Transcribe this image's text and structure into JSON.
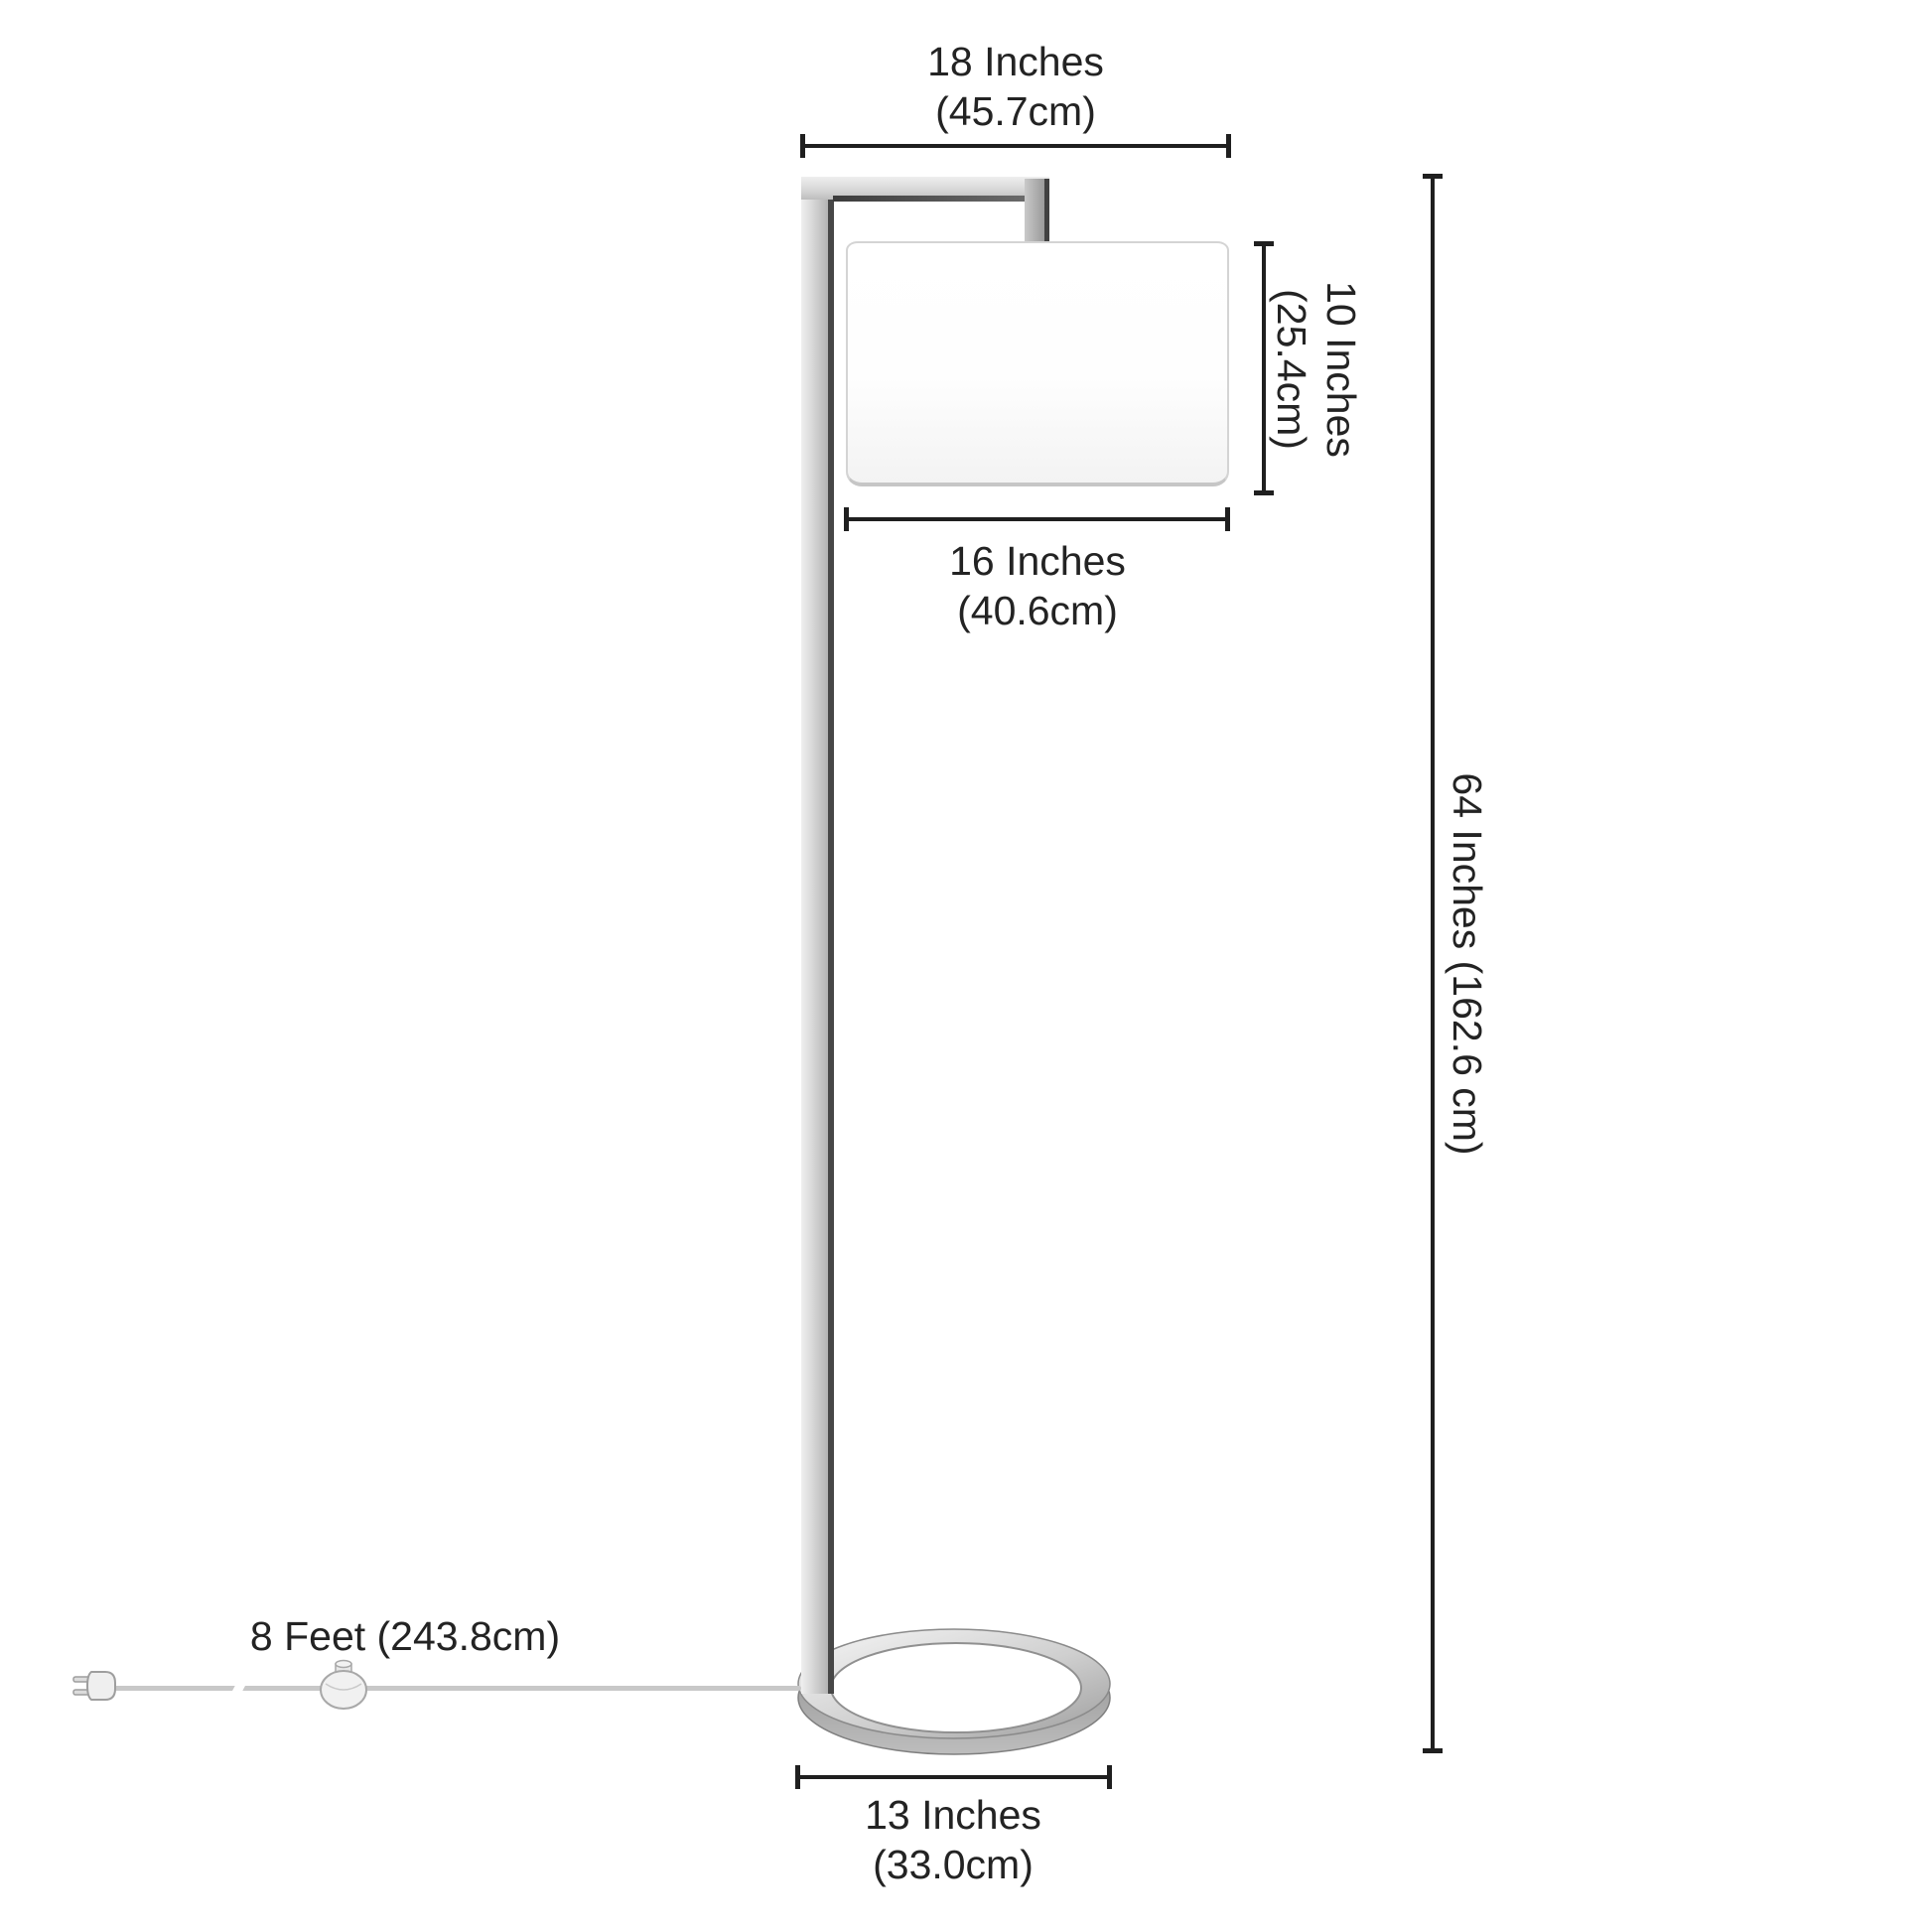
{
  "figure": {
    "type": "product-dimension-diagram",
    "subject": "floor lamp with drum shade, ring base, inline switch and plug"
  },
  "labels": {
    "arm_width": {
      "line1": "18 Inches",
      "line2": "(45.7cm)"
    },
    "shade_height": {
      "line1": "10 Inches",
      "line2": "(25.4cm)"
    },
    "shade_width": {
      "line1": "16 Inches",
      "line2": "(40.6cm)"
    },
    "lamp_height": {
      "text": "64 Inches (162.6 cm)"
    },
    "cord_length": {
      "text": "8 Feet (243.8cm)"
    },
    "base_width": {
      "line1": "13 Inches",
      "line2": "(33.0cm)"
    }
  },
  "colors": {
    "line": "#1f1f1f",
    "text": "#232323",
    "metal_light": "#ececec",
    "metal_mid": "#c4c4c4",
    "metal_dark": "#474747",
    "shade_border": "#d4d4d4",
    "cord": "#c8c8c8"
  }
}
